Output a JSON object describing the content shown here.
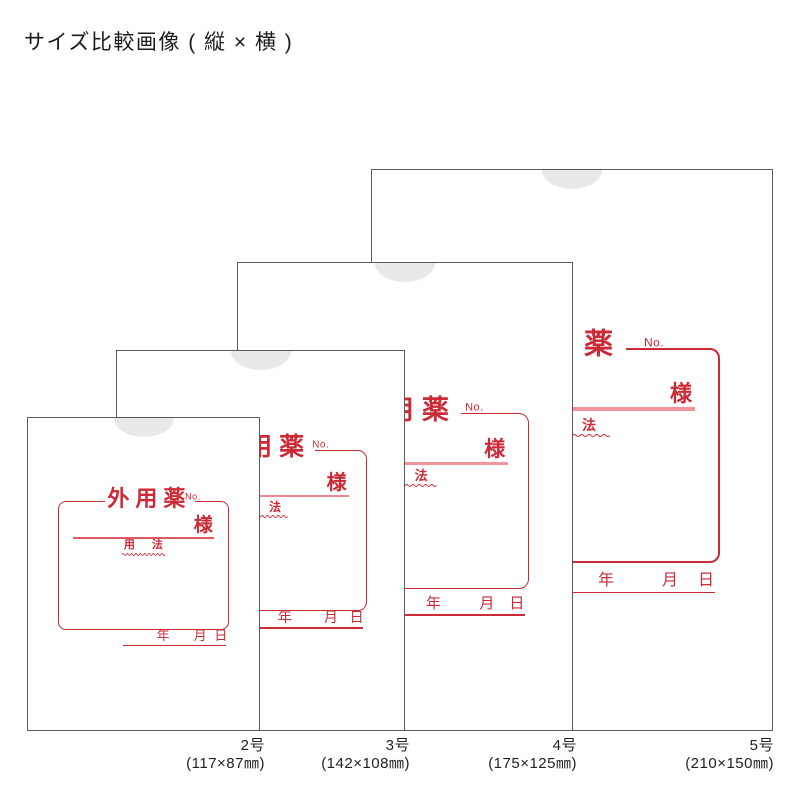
{
  "page": {
    "title": "サイズ比較画像 ( 縦 × 横 )"
  },
  "envelope_print": {
    "title": "外用薬",
    "no_label": "No.",
    "name_suffix": "様",
    "usage_label": "用法",
    "date_fields": [
      "年",
      "月",
      "日"
    ]
  },
  "sizes": [
    {
      "name": "2号",
      "dimensions": "(117×87㎜)"
    },
    {
      "name": "3号",
      "dimensions": "(142×108㎜)"
    },
    {
      "name": "4号",
      "dimensions": "(175×125㎜)"
    },
    {
      "name": "5号",
      "dimensions": "(210×150㎜)"
    }
  ],
  "colors": {
    "print_red": "#cc2a36",
    "name_line_pink": "#f0959b",
    "notch_gray": "#e8e9e9",
    "envelope_border_gray": "#5a5a5a"
  }
}
